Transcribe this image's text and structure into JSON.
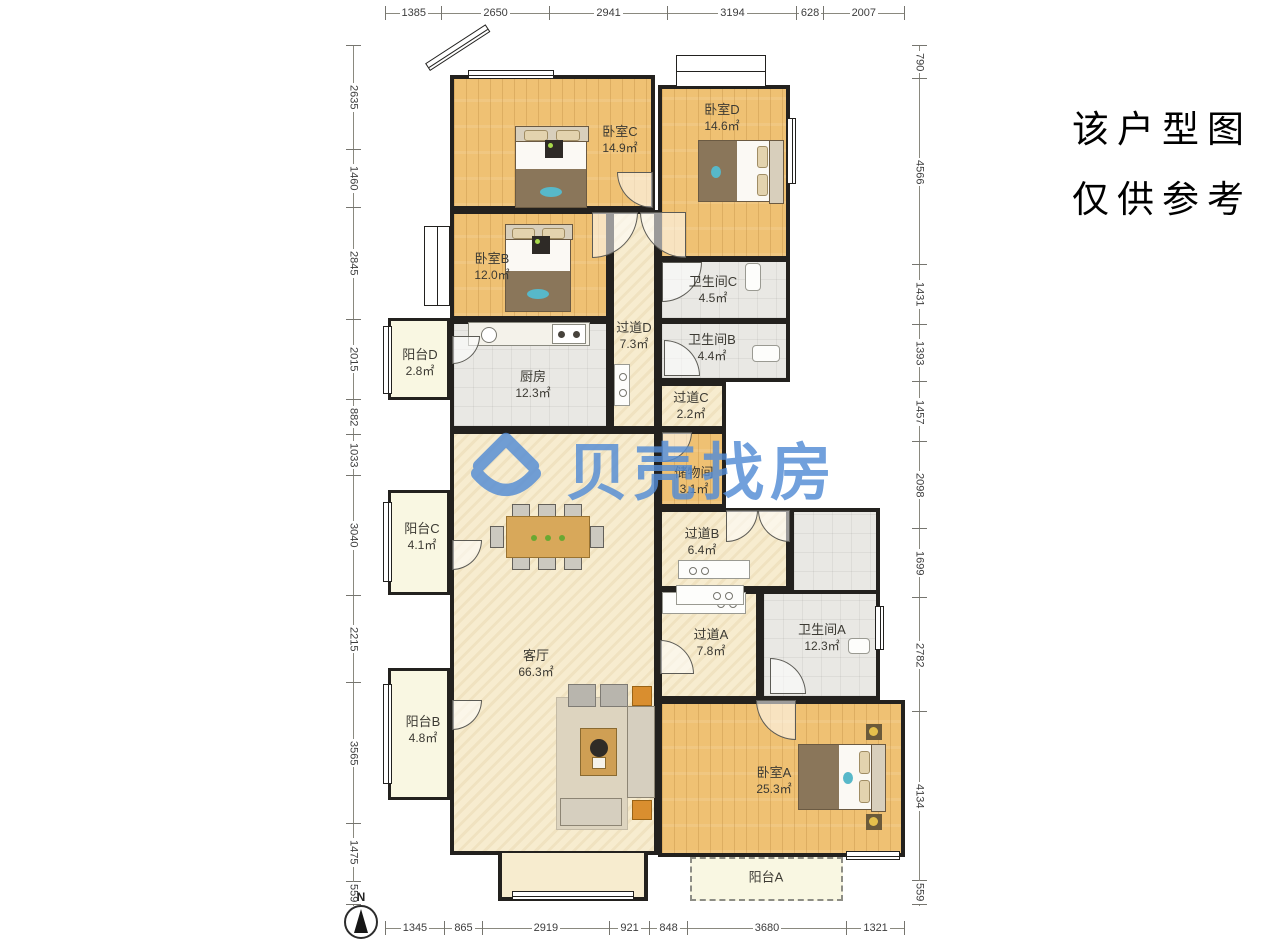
{
  "page": {
    "background": "#ffffff"
  },
  "disclaimer": {
    "line1": "该户型图",
    "line2": "仅供参考"
  },
  "watermark": {
    "brand": "贝壳找房",
    "color": "#538cd5",
    "logo_icon": "beike-house-logo"
  },
  "compass": {
    "label": "N"
  },
  "area_unit": "㎡",
  "rooms": {
    "bedroomC": {
      "name": "卧室C",
      "area": "14.9㎡"
    },
    "bedroomD": {
      "name": "卧室D",
      "area": "14.6㎡"
    },
    "bedroomB": {
      "name": "卧室B",
      "area": "12.0㎡"
    },
    "bedroomA": {
      "name": "卧室A",
      "area": "25.3㎡"
    },
    "bathC": {
      "name": "卫生间C",
      "area": "4.5㎡"
    },
    "bathB": {
      "name": "卫生间B",
      "area": "4.4㎡"
    },
    "bathA": {
      "name": "卫生间A",
      "area": "12.3㎡"
    },
    "hallD": {
      "name": "过道D",
      "area": "7.3㎡"
    },
    "hallC": {
      "name": "过道C",
      "area": "2.2㎡"
    },
    "hallB": {
      "name": "过道B",
      "area": "6.4㎡"
    },
    "hallA": {
      "name": "过道A",
      "area": "7.8㎡"
    },
    "kitchen": {
      "name": "厨房",
      "area": "12.3㎡"
    },
    "storage": {
      "name": "储物间",
      "area": "3.1㎡"
    },
    "living": {
      "name": "客厅",
      "area": "66.3㎡"
    },
    "balconyD": {
      "name": "阳台D",
      "area": "2.8㎡"
    },
    "balconyC": {
      "name": "阳台C",
      "area": "4.1㎡"
    },
    "balconyB": {
      "name": "阳台B",
      "area": "4.8㎡"
    },
    "balconyA": {
      "name": "阳台A",
      "area": ""
    }
  },
  "dimensions": {
    "unit": "mm",
    "top": [
      1385,
      2650,
      2941,
      3194,
      628,
      2007
    ],
    "bottom": [
      1345,
      865,
      2919,
      921,
      848,
      3680,
      1321
    ],
    "left": [
      2635,
      1460,
      2845,
      2015,
      882,
      1033,
      3040,
      2215,
      3565,
      1475,
      559
    ],
    "right": [
      790,
      4566,
      1431,
      1393,
      1457,
      2098,
      1699,
      2782,
      4134,
      559
    ]
  },
  "colors": {
    "wall": "#23211e",
    "wood_floor": "#efc173",
    "tile_floor": "#e9e8e4",
    "cream_floor": "#f7eccf",
    "balcony_floor": "#f9f7e2",
    "watermark_blue": "#538cd5",
    "accent_teal": "#57b8c9"
  }
}
